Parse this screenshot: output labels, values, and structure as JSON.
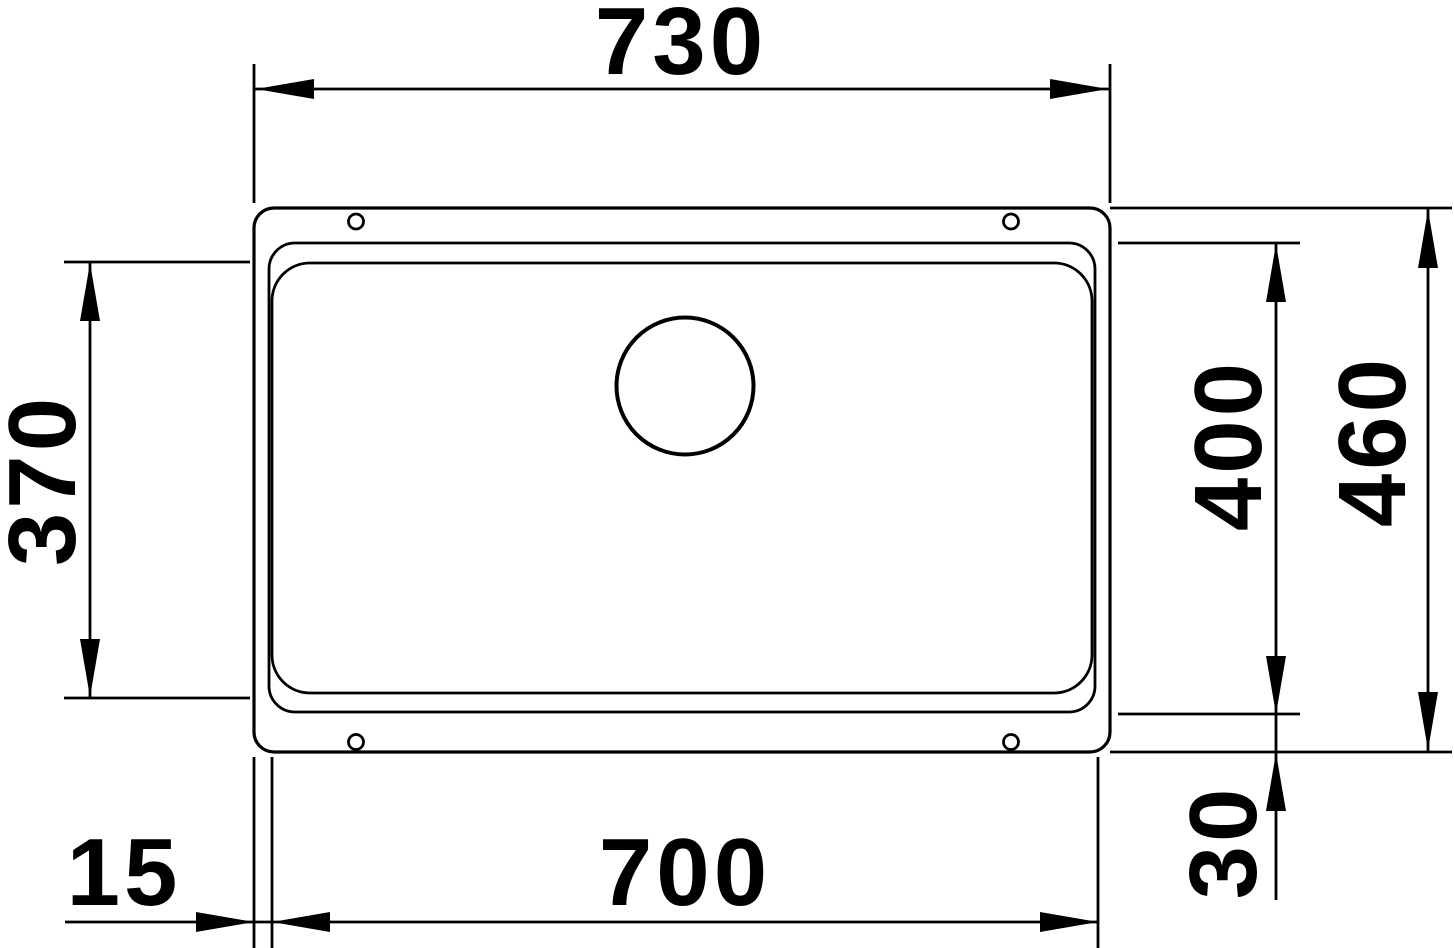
{
  "drawing": {
    "background": "#ffffff",
    "stroke_color": "#000000",
    "labels": {
      "outer_width_top": "730",
      "basin_width_bottom": "700",
      "inner_height_left": "370",
      "basin_height_right": "400",
      "outer_height_right": "460",
      "rim_offset_bottom_right": "30",
      "rim_offset_bottom_left": "15"
    }
  }
}
